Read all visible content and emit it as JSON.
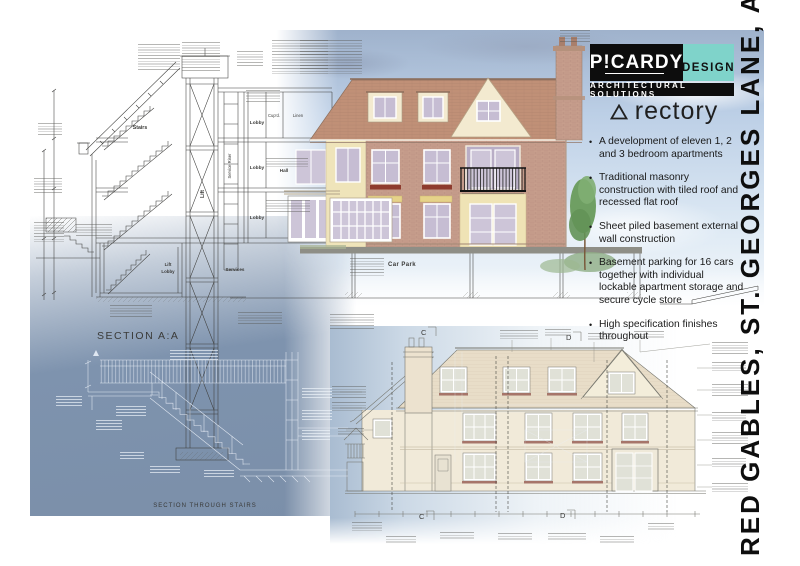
{
  "brand": {
    "name": "P!CARDY",
    "design": "DESIGN",
    "tagline": "ARCHITECTURAL SOLUTIONS"
  },
  "project": {
    "title": "rectory",
    "bullets": [
      "A development of eleven 1, 2 and 3 bedroom apartments",
      "Traditional masonry construction with tiled roof and recessed flat roof",
      "Sheet piled basement external wall construction",
      "Basement parking for 16 cars together with individual lockable apartment storage and secure cycle store",
      "High specification finishes throughout"
    ]
  },
  "side_title": "RED GABLES, ST. GEORGES LANE, ASCOT",
  "drawings": {
    "section_aa": {
      "title": "SECTION A:A",
      "stairs": "Stairs",
      "lift": "Lift",
      "service_riser": "Service Riser",
      "lobby": "Lobby",
      "cupboard": "Cup'd.",
      "linen": "Linen",
      "hall": "Hall",
      "services": "Services",
      "car_park": "Car Park"
    },
    "stairs_section": {
      "title": "SECTION THROUGH STAIRS"
    },
    "elevation": {
      "marker_c": "C",
      "marker_d": "D"
    }
  },
  "colors": {
    "blueprint_blue": "#7e93ae",
    "logo_teal": "#7fd3ca",
    "brick": "#c79e8c",
    "roof_tile": "#c09077",
    "render_cream": "#efe4ba",
    "sky_blue": "#bccfe6",
    "window_glass": "#c6bdd3",
    "elevation_wall": "#f1ead9",
    "sill_red": "#8e3b2e"
  }
}
